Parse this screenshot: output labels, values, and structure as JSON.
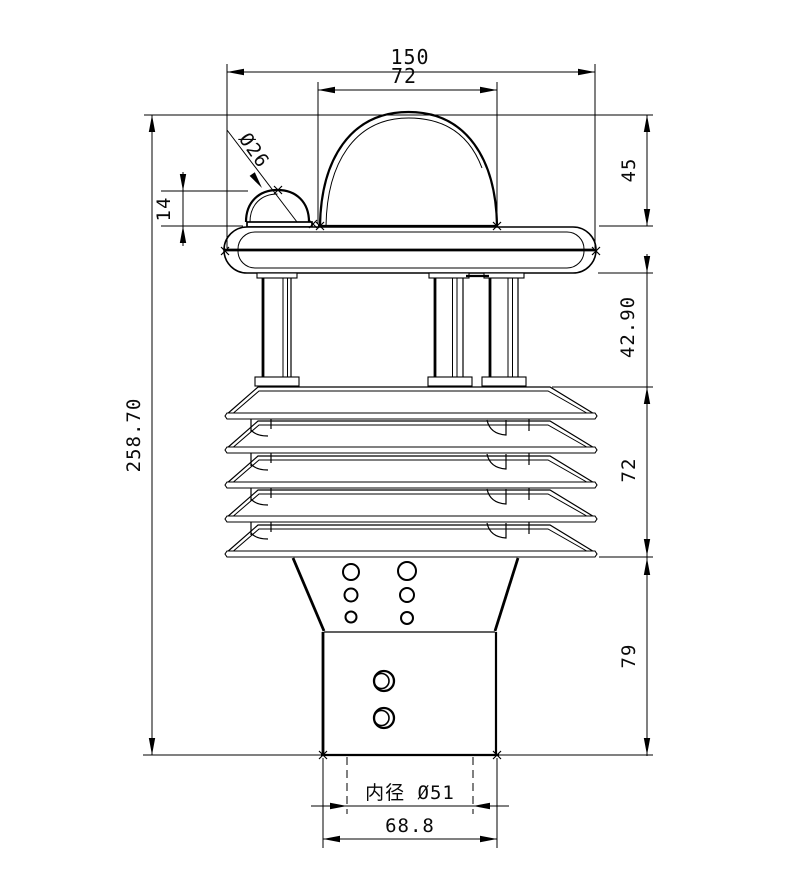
{
  "drawing": {
    "background": "#ffffff",
    "line_color": "#000000",
    "dimensions": {
      "overall_width": "150",
      "dome_width": "72",
      "dome_height": "45",
      "small_dome_diameter": "Ø26",
      "small_dome_height": "14",
      "total_height": "258.70",
      "column_section_height": "42.90",
      "louver_section_height": "72",
      "base_section_height": "79",
      "inner_diameter_label": "内径 Ø51",
      "base_outer_width": "68.8"
    }
  }
}
